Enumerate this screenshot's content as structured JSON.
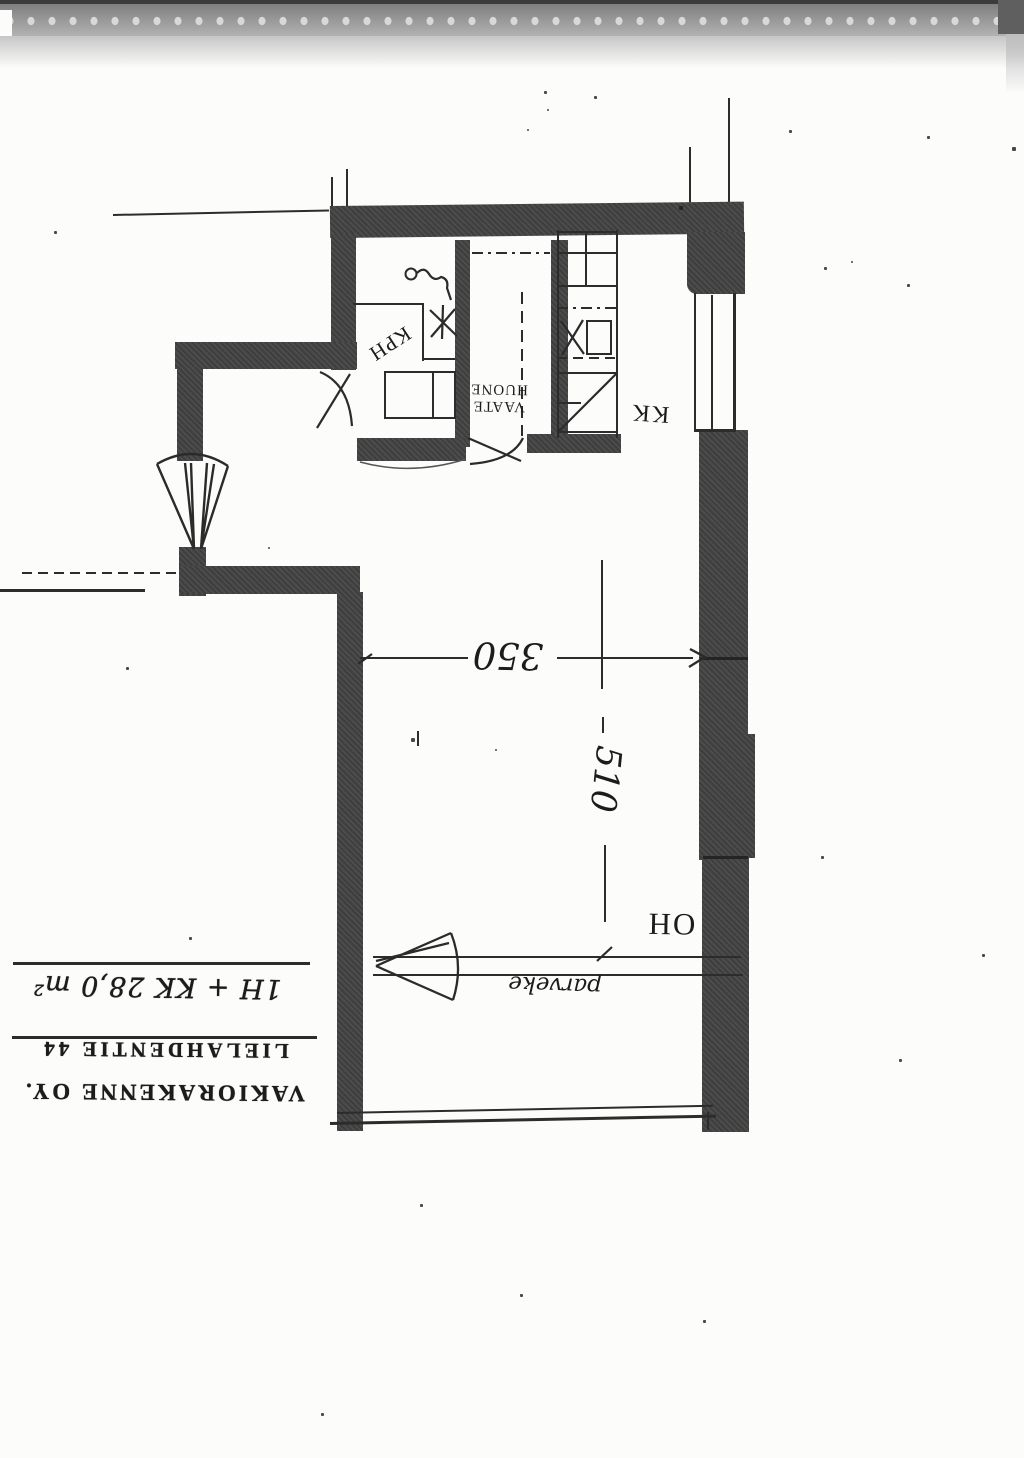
{
  "plan": {
    "rooms": {
      "kph": "KPH",
      "vaate_line1": "VAATE",
      "vaate_line2": "HUONE",
      "kk": "KK",
      "oh": "OH",
      "parveke": "parveke"
    },
    "dimensions": {
      "width": "350",
      "length": "510"
    }
  },
  "title_block": {
    "apartment_type_area": "1H + KK 28,0 m²",
    "address": "LIELAHDENTIE 44",
    "company": "VAKIORAKENNE OY."
  },
  "colors": {
    "ink": "#2c2c2c",
    "wall_fill": "#424242",
    "paper": "#fcfcfb"
  }
}
